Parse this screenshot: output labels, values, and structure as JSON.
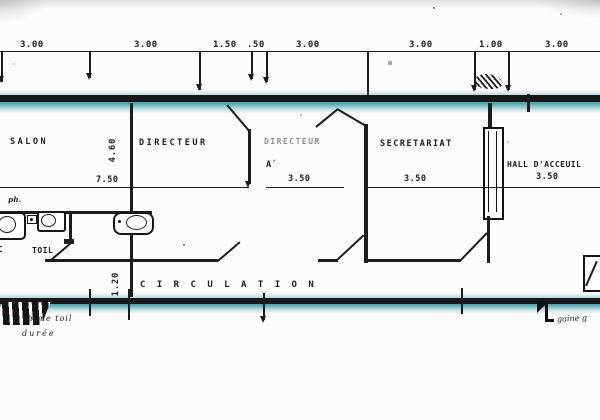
{
  "drawing": {
    "type": "scanned-floor-plan",
    "top_dimensions": [
      "3.00",
      "3.00",
      "1.50",
      ".50",
      "3.00",
      "3.00",
      "1.00",
      "3.00"
    ],
    "room_labels": {
      "salon": "SALON",
      "directeur": "DIRECTEUR",
      "directeur_adjoint": "DIRECTEUR",
      "directeur_adjoint_sub": "A´",
      "secretariat": "SECRETARIAT",
      "hall": "HALL D'ACCEUIL",
      "circulation": "C I R C U L A T I O N",
      "toilet": "TOIL"
    },
    "width_dimensions": {
      "salon": "7.50",
      "directeur_adjoint": "3.50",
      "secretariat": "3.50",
      "hall": "3.50"
    },
    "depth_dimensions": {
      "rooms": "4.60",
      "circulation": "1.20"
    },
    "annotations": {
      "ph": "ph.",
      "wc": "WC",
      "note_bottom_left_line1": "vh-me toil",
      "note_bottom_left_line2": "durée",
      "note_bottom_right": "gaine g"
    },
    "colors": {
      "ink": "#1c1c1c",
      "wall_highlight_teal": "#45a9b1"
    }
  }
}
